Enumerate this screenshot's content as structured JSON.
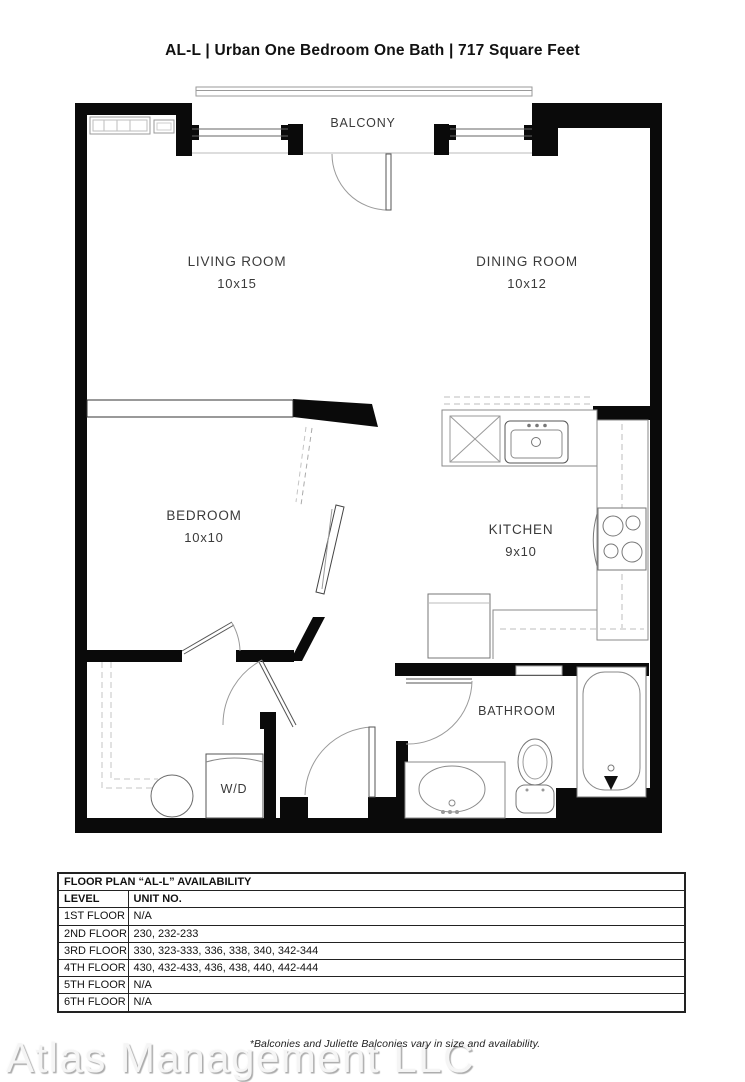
{
  "title": "AL-L | Urban One Bedroom One Bath | 717  Square Feet",
  "floor_plan": {
    "rooms": {
      "balcony": {
        "name": "BALCONY"
      },
      "living": {
        "name": "LIVING ROOM",
        "dims": "10x15"
      },
      "dining": {
        "name": "DINING ROOM",
        "dims": "10x12"
      },
      "bedroom": {
        "name": "BEDROOM",
        "dims": "10x10"
      },
      "kitchen": {
        "name": "KITCHEN",
        "dims": "9x10"
      },
      "bathroom": {
        "name": "BATHROOM"
      },
      "laundry": {
        "label": "W/D"
      }
    },
    "fixtures": [
      "kitchen-sink",
      "dishwasher",
      "stove",
      "refrigerator",
      "vanity-sink",
      "toilet",
      "bathtub",
      "washer-dryer",
      "water-heater",
      "baseboard-heater",
      "closet-rod"
    ],
    "colors": {
      "wall": "#0a0a0a",
      "fixture_line": "#888888",
      "dashed_line": "#bdbdbd"
    }
  },
  "availability_table": {
    "title": "FLOOR PLAN “AL-L” AVAILABILITY",
    "columns": [
      "LEVEL",
      "UNIT NO."
    ],
    "rows": [
      [
        "1ST FLOOR",
        "N/A"
      ],
      [
        "2ND FLOOR",
        "230, 232-233"
      ],
      [
        "3RD FLOOR",
        "330, 323-333, 336, 338, 340, 342-344"
      ],
      [
        "4TH FLOOR",
        "430, 432-433, 436, 438, 440, 442-444"
      ],
      [
        "5TH FLOOR",
        "N/A"
      ],
      [
        "6TH FLOOR",
        "N/A"
      ]
    ]
  },
  "footnote": "*Balconies and Juliette Balconies vary in size and availability.",
  "watermark": {
    "text": "Atlas Management LLC"
  }
}
